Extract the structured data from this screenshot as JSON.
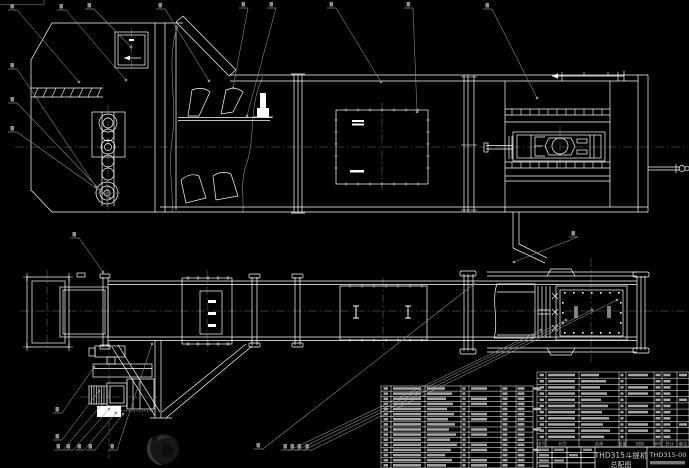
{
  "window": {
    "kind": "CAD drawing viewport",
    "background": "#000000"
  },
  "colors": {
    "drawing_lines": "#ffffff",
    "leader_lines": "#8f8f8f",
    "center_lines": "#6f6f6f",
    "table_text": "#a8a8a8",
    "title_text": "#d6d6d6",
    "watermark": "#2a2a2a"
  },
  "title_block": {
    "product_title": "THD315斗提机",
    "drawing_type": "总配图",
    "drawing_number": "THD315-00"
  },
  "bom_table": {
    "header_labels": [
      "序号",
      "代号",
      "名称",
      "数量",
      "材料",
      "单件",
      "总计",
      "备注"
    ],
    "left_section": {
      "x": 381,
      "y": 386,
      "w": 152,
      "rows": 16,
      "row_h": 5.12,
      "cols": [
        0,
        10,
        44,
        80,
        88,
        120,
        135,
        152
      ]
    },
    "right_section": {
      "x": 537,
      "y": 372,
      "w": 152,
      "rows": 11,
      "row_h": 6.18,
      "cols": [
        0,
        9,
        42,
        82,
        89,
        117,
        125,
        140,
        152
      ]
    },
    "header_band": {
      "x": 537,
      "y": 440,
      "w": 152,
      "h": 7
    }
  },
  "balloons": {
    "note": "part item leaders with illegible single-digit labels",
    "items": [
      {
        "x": 12,
        "y": 10,
        "tx": 79,
        "ty": 82
      },
      {
        "x": 61,
        "y": 10,
        "tx": 126,
        "ty": 80
      },
      {
        "x": 89,
        "y": 9,
        "tx": 131,
        "ty": 47
      },
      {
        "x": 160,
        "y": 9,
        "tx": 209,
        "ty": 81
      },
      {
        "x": 243,
        "y": 8,
        "tx": 233,
        "ty": 88
      },
      {
        "x": 271,
        "y": 8,
        "tx": 247,
        "ty": 116
      },
      {
        "x": 331,
        "y": 8,
        "tx": 381,
        "ty": 82
      },
      {
        "x": 408,
        "y": 8,
        "tx": 417,
        "ty": 112
      },
      {
        "x": 487,
        "y": 9,
        "tx": 537,
        "ty": 98
      },
      {
        "x": 12,
        "y": 69,
        "tx": 96,
        "ty": 187
      },
      {
        "x": 12,
        "y": 103,
        "tx": 103,
        "ty": 193
      },
      {
        "x": 12,
        "y": 132,
        "tx": 110,
        "ty": 198
      },
      {
        "x": 74,
        "y": 238,
        "tx": 103,
        "ty": 272
      },
      {
        "x": 573,
        "y": 237,
        "tx": 514,
        "ty": 262
      },
      {
        "x": 57,
        "y": 413,
        "tx": 94,
        "ty": 367
      },
      {
        "x": 57,
        "y": 440,
        "tx": 99,
        "ty": 391
      },
      {
        "x": 58,
        "y": 450,
        "tx": 102,
        "ty": 404
      },
      {
        "x": 68,
        "y": 450,
        "tx": 109,
        "ty": 409
      },
      {
        "x": 79,
        "y": 450,
        "tx": 116,
        "ty": 413
      },
      {
        "x": 90,
        "y": 450,
        "tx": 123,
        "ty": 414
      },
      {
        "x": 112,
        "y": 450,
        "tx": 152,
        "ty": 344
      },
      {
        "x": 258,
        "y": 449,
        "tx": 474,
        "ty": 284
      },
      {
        "x": 285,
        "y": 450,
        "tx": 541,
        "ty": 330
      },
      {
        "x": 292,
        "y": 450,
        "tx": 566,
        "ty": 320
      },
      {
        "x": 299,
        "y": 450,
        "tx": 592,
        "ty": 310
      },
      {
        "x": 307,
        "y": 450,
        "tx": 617,
        "ty": 300
      }
    ]
  }
}
